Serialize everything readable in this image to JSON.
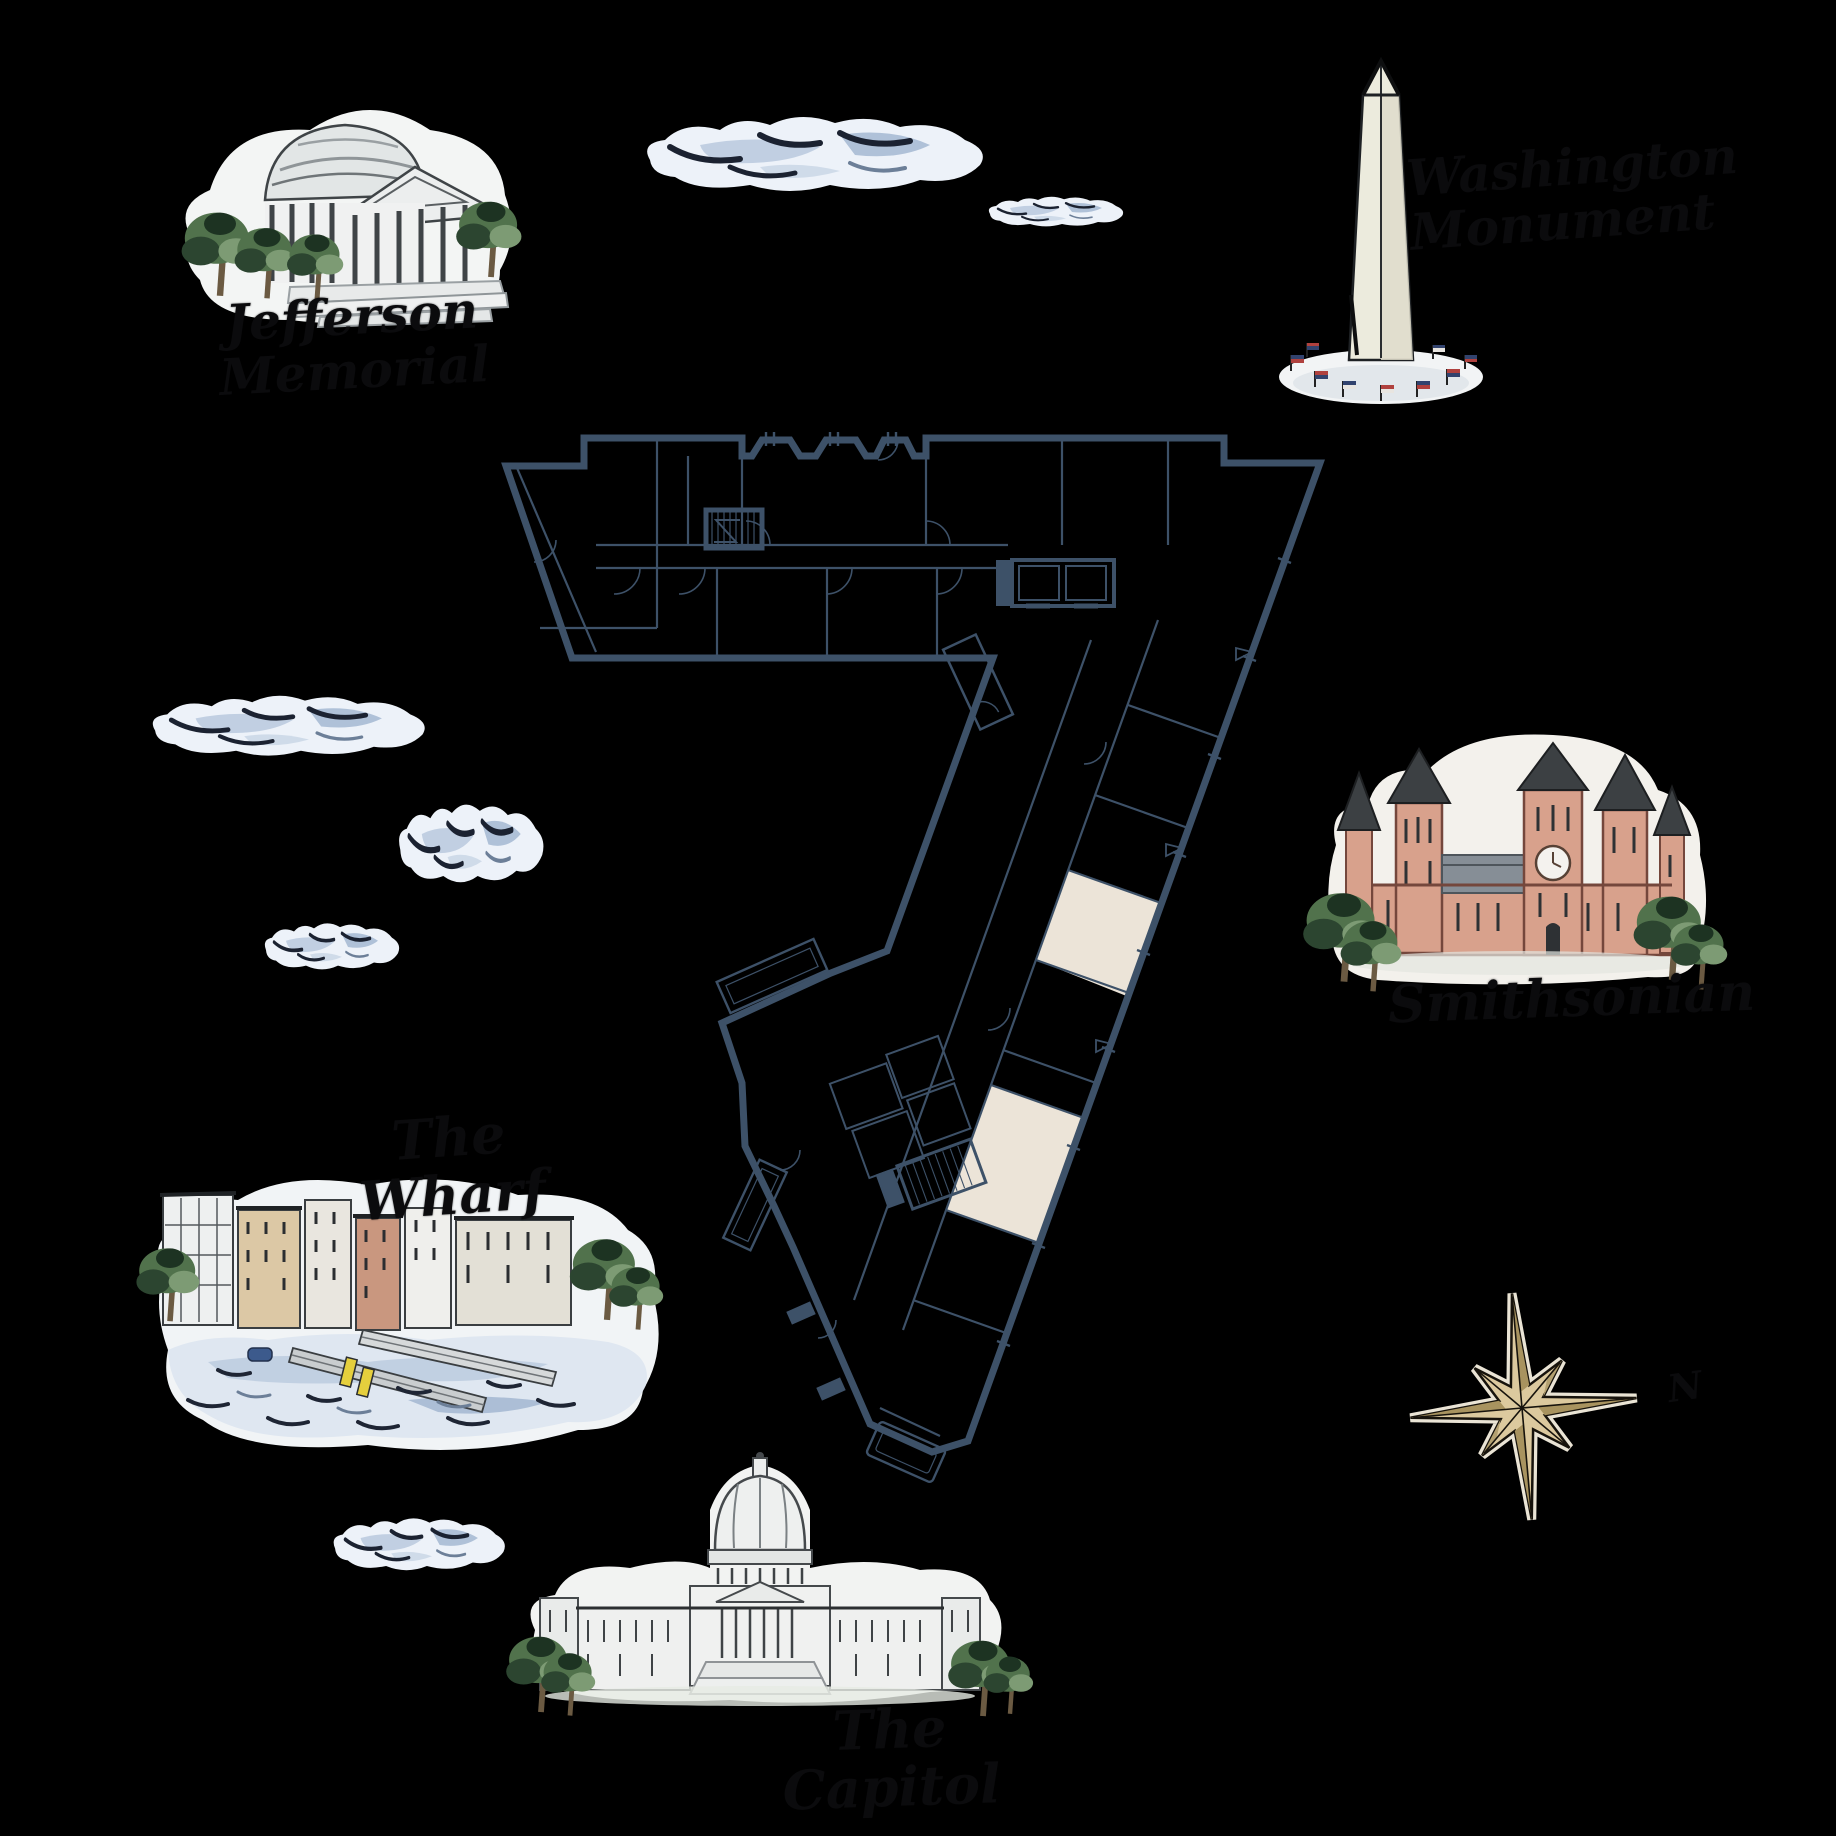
{
  "title": "Illustrated Washington DC map with building floor plan",
  "colors": {
    "background": "#000000",
    "floorplan_line": "#3d5168",
    "room_highlight": "#ece4d8",
    "cloud_fill": "#edf2f9",
    "cloud_shade": "#b9c9de",
    "cloud_ink": "#1b2231",
    "star_gold": "#dcc99e",
    "smithsonian_brick": "#d8a18c",
    "label_ink": "#0b0b0d"
  },
  "landmarks": {
    "jefferson": {
      "label": "Jefferson Memorial"
    },
    "washington": {
      "label": "Washington\nMonument"
    },
    "smithsonian": {
      "label": "Smithsonian"
    },
    "wharf": {
      "label": "The Wharf"
    },
    "capitol": {
      "label": "The Capitol"
    }
  },
  "compass": {
    "north_label": "N"
  }
}
